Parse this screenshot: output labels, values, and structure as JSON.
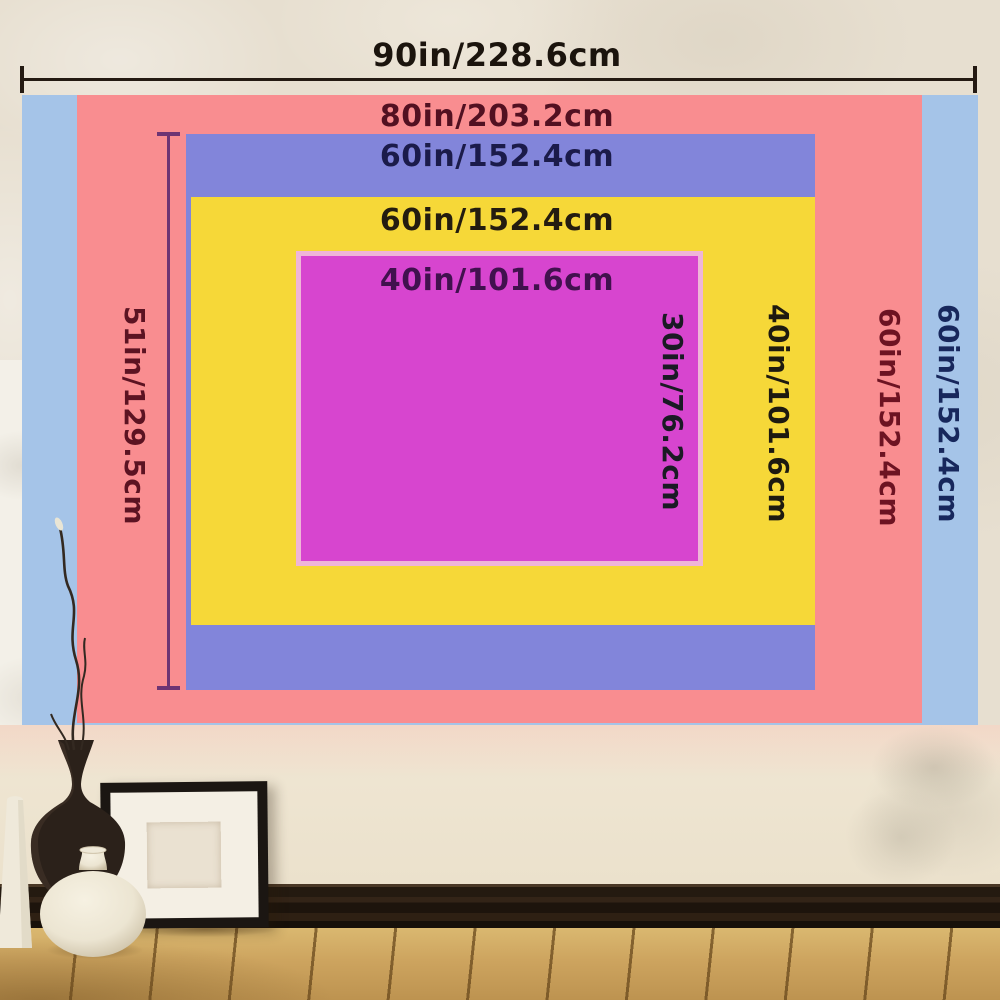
{
  "sizes": [
    {
      "name": "blue",
      "color": "#a5c4e8",
      "width_label": "90in/228.6cm",
      "height_label": "60in/152.4cm"
    },
    {
      "name": "pink",
      "color": "#f98d90",
      "width_label": "80in/203.2cm",
      "height_label": "60in/152.4cm"
    },
    {
      "name": "purple",
      "color": "#8285da",
      "width_label": "60in/152.4cm",
      "height_label": "51in/129.5cm"
    },
    {
      "name": "yellow",
      "color": "#f6d838",
      "width_label": "60in/152.4cm",
      "height_label": "40in/101.6cm"
    },
    {
      "name": "magenta",
      "color": "#d745cf",
      "width_label": "40in/101.6cm",
      "height_label": "30in/76.2cm"
    }
  ],
  "scene_colors": {
    "wall": "#e7dfd0",
    "magenta_border": "#efb5d8",
    "ruler_horizontal": "#241a12",
    "ruler_vertical": "#6e3473",
    "baseboard": "#241a10",
    "floor_wood": "#cda45f",
    "frame": "#1b1612"
  }
}
